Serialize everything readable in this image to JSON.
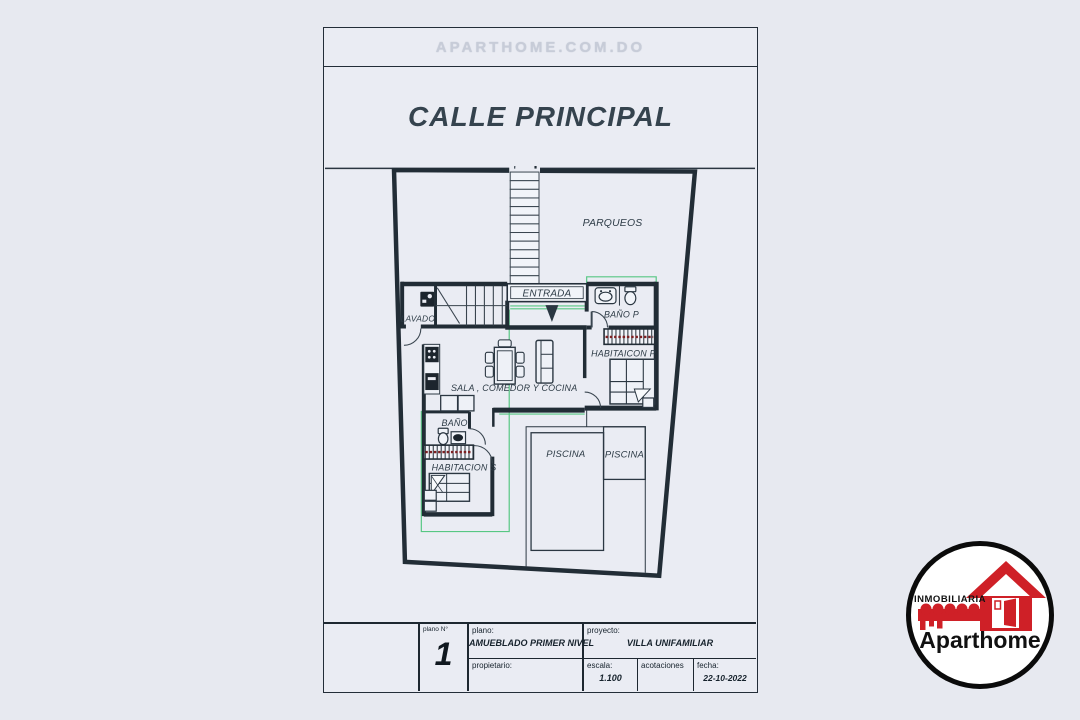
{
  "page": {
    "background": "#e7e9f0"
  },
  "sheet": {
    "watermark": "APARTHOME.COM.DO",
    "street_label": "CALLE PRINCIPAL"
  },
  "plan": {
    "rooms": {
      "parqueos": "PARQUEOS",
      "entrada": "ENTRADA",
      "lavado": "LAVADO",
      "bano_p": "BAÑO P",
      "habitacion_p": "HABITAICON P",
      "sala": "SALA , COMEDOR Y COCINA",
      "bano_s": "BAÑO",
      "habitacion_s": "HABITACION S",
      "piscina_a": "PISCINA",
      "piscina_b": "PISCINA"
    },
    "colors": {
      "wall": "#212c35",
      "accent_green": "#57c783",
      "closet_red": "#7c2022",
      "label_text": "#2d3b46"
    }
  },
  "title_block": {
    "plano_n_label": "plano N°",
    "plano_number": "1",
    "plano_label": "plano:",
    "plano_value": "AMUEBLADO PRIMER NIVEL",
    "propietario_label": "propietario:",
    "proyecto_label": "proyecto:",
    "proyecto_value": "VILLA UNIFAMILIAR",
    "escala_label": "escala:",
    "escala_value": "1.100",
    "acotaciones_label": "acotaciones",
    "fecha_label": "fecha:",
    "fecha_value": "22-10-2022"
  },
  "logo": {
    "top_text": "INMOBILIARIA",
    "brand_regular": "Apart",
    "brand_bold": "home",
    "brand_color": "#111111",
    "red": "#cf2027"
  }
}
